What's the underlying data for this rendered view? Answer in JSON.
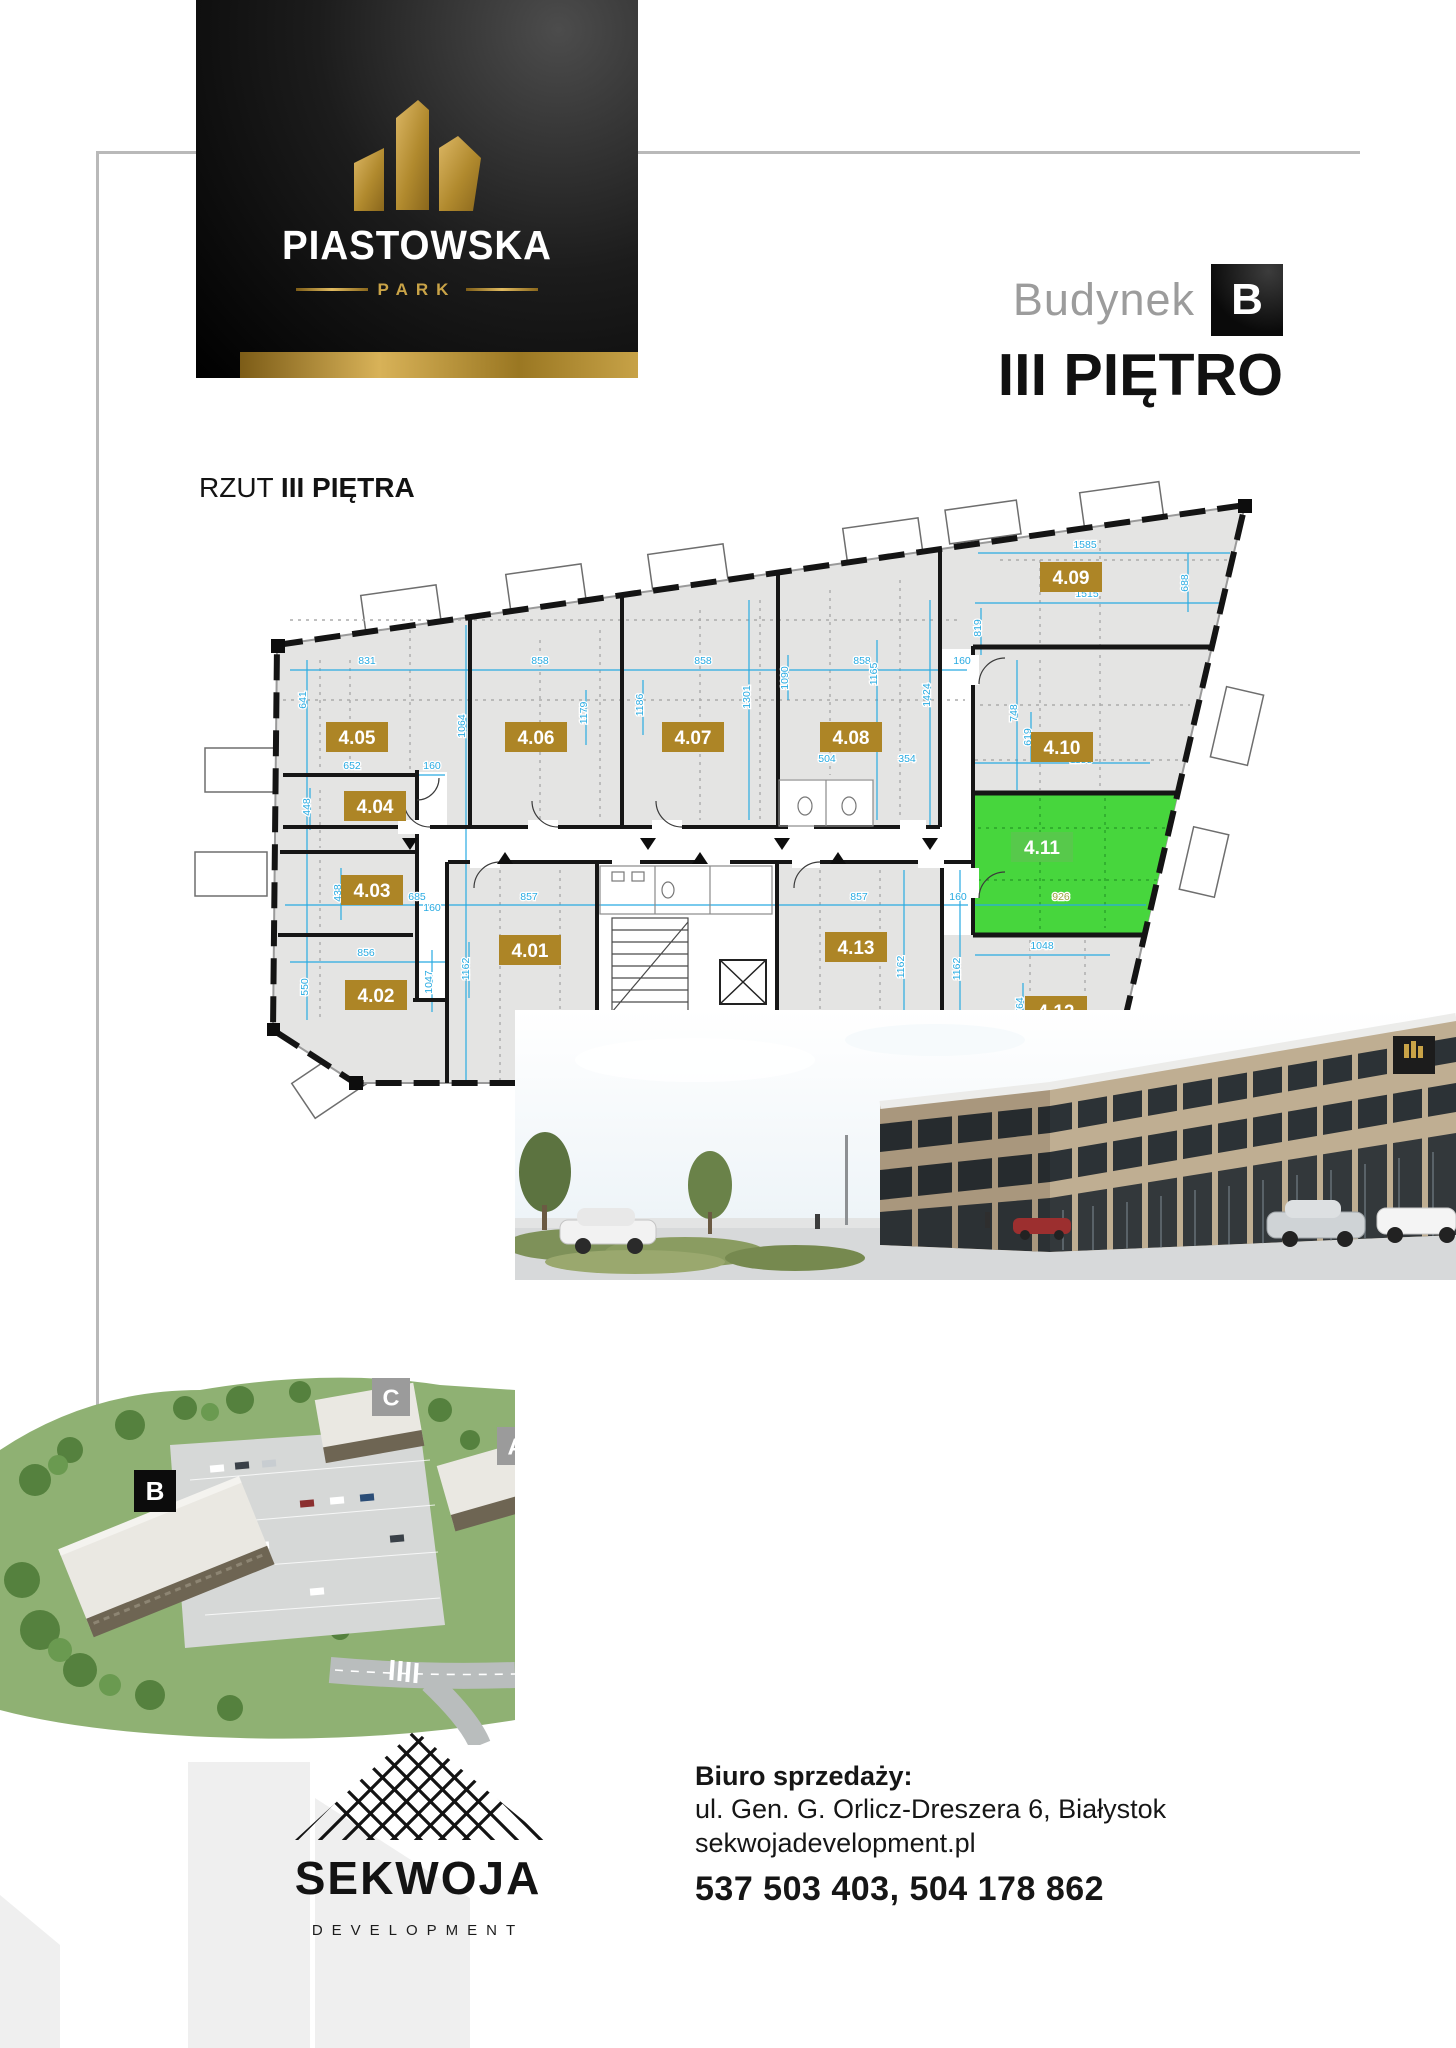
{
  "brand": {
    "name": "PIASTOWSKA",
    "sub": "PARK"
  },
  "heading": {
    "building_label": "Budynek",
    "building_letter": "B",
    "floor_title": "III PIĘTRO"
  },
  "plan": {
    "title_prefix": "RZUT ",
    "title_bold": "III PIĘTRA",
    "colors": {
      "badge_gold": "#ad8526",
      "badge_green": "#57c94b",
      "room_green": "#47d63d",
      "dim_blue": "#29abe2"
    },
    "units": [
      {
        "id": "4.01",
        "x": 530,
        "y": 950,
        "highlighted": false
      },
      {
        "id": "4.02",
        "x": 376,
        "y": 995,
        "highlighted": false
      },
      {
        "id": "4.03",
        "x": 372,
        "y": 890,
        "highlighted": false
      },
      {
        "id": "4.04",
        "x": 375,
        "y": 806,
        "highlighted": false
      },
      {
        "id": "4.05",
        "x": 357,
        "y": 737,
        "highlighted": false
      },
      {
        "id": "4.06",
        "x": 536,
        "y": 737,
        "highlighted": false
      },
      {
        "id": "4.07",
        "x": 693,
        "y": 737,
        "highlighted": false
      },
      {
        "id": "4.08",
        "x": 851,
        "y": 737,
        "highlighted": false
      },
      {
        "id": "4.09",
        "x": 1071,
        "y": 577,
        "highlighted": false
      },
      {
        "id": "4.10",
        "x": 1062,
        "y": 747,
        "highlighted": false
      },
      {
        "id": "4.11",
        "x": 1042,
        "y": 847,
        "highlighted": true
      },
      {
        "id": "4.12",
        "x": 1056,
        "y": 1011,
        "highlighted": false
      },
      {
        "id": "4.13",
        "x": 856,
        "y": 947,
        "highlighted": false
      }
    ],
    "dimensions": [
      {
        "v": "831",
        "x": 367,
        "y": 664,
        "r": 0
      },
      {
        "v": "858",
        "x": 540,
        "y": 664,
        "r": 0
      },
      {
        "v": "858",
        "x": 703,
        "y": 664,
        "r": 0
      },
      {
        "v": "858",
        "x": 862,
        "y": 664,
        "r": 0
      },
      {
        "v": "160",
        "x": 962,
        "y": 664,
        "r": 0
      },
      {
        "v": "1585",
        "x": 1085,
        "y": 548,
        "r": 0
      },
      {
        "v": "1515",
        "x": 1087,
        "y": 597,
        "r": 0
      },
      {
        "v": "688",
        "x": 1188,
        "y": 583,
        "r": -90
      },
      {
        "v": "819",
        "x": 981,
        "y": 628,
        "r": -90
      },
      {
        "v": "641",
        "x": 306,
        "y": 700,
        "r": -90
      },
      {
        "v": "1064",
        "x": 465,
        "y": 726,
        "r": -90
      },
      {
        "v": "1179",
        "x": 587,
        "y": 713,
        "r": -90
      },
      {
        "v": "1186",
        "x": 643,
        "y": 705,
        "r": -90
      },
      {
        "v": "1301",
        "x": 750,
        "y": 697,
        "r": -90
      },
      {
        "v": "1090",
        "x": 788,
        "y": 678,
        "r": -90
      },
      {
        "v": "1165",
        "x": 877,
        "y": 674,
        "r": -90
      },
      {
        "v": "1424",
        "x": 930,
        "y": 695,
        "r": -90
      },
      {
        "v": "748",
        "x": 1017,
        "y": 713,
        "r": -90
      },
      {
        "v": "619",
        "x": 1031,
        "y": 737,
        "r": -90
      },
      {
        "v": "652",
        "x": 352,
        "y": 769,
        "r": 0
      },
      {
        "v": "160",
        "x": 432,
        "y": 769,
        "r": 0
      },
      {
        "v": "448",
        "x": 310,
        "y": 807,
        "r": -90
      },
      {
        "v": "504",
        "x": 827,
        "y": 762,
        "r": 0
      },
      {
        "v": "354",
        "x": 907,
        "y": 762,
        "r": 0
      },
      {
        "v": "438",
        "x": 341,
        "y": 893,
        "r": -90
      },
      {
        "v": "685",
        "x": 417,
        "y": 900,
        "r": 0
      },
      {
        "v": "160",
        "x": 432,
        "y": 911,
        "r": 0
      },
      {
        "v": "857",
        "x": 529,
        "y": 900,
        "r": 0
      },
      {
        "v": "857",
        "x": 859,
        "y": 900,
        "r": 0
      },
      {
        "v": "160",
        "x": 958,
        "y": 900,
        "r": 0
      },
      {
        "v": "856",
        "x": 366,
        "y": 956,
        "r": 0
      },
      {
        "v": "550",
        "x": 308,
        "y": 987,
        "r": -90
      },
      {
        "v": "1047",
        "x": 432,
        "y": 982,
        "r": -90
      },
      {
        "v": "1162",
        "x": 469,
        "y": 969,
        "r": -90
      },
      {
        "v": "1162",
        "x": 904,
        "y": 967,
        "r": -90
      },
      {
        "v": "1162",
        "x": 960,
        "y": 969,
        "r": -90
      },
      {
        "v": "926",
        "x": 1061,
        "y": 900,
        "r": 0,
        "c": "#9aa23a"
      },
      {
        "v": "1048",
        "x": 1042,
        "y": 949,
        "r": 0
      },
      {
        "v": "764",
        "x": 1023,
        "y": 1006,
        "r": -90
      },
      {
        "v": "1155",
        "x": 1081,
        "y": 763,
        "r": 0
      }
    ]
  },
  "aerial": {
    "labels": [
      {
        "t": "B",
        "x": 134,
        "y": 140,
        "size": 42,
        "style": "dark"
      },
      {
        "t": "C",
        "x": 372,
        "y": 48,
        "size": 38,
        "style": "gray"
      },
      {
        "t": "A",
        "x": 497,
        "y": 97,
        "size": 38,
        "style": "gray"
      }
    ]
  },
  "footer": {
    "brand": "SEKWOJA",
    "brand_sub": "DEVELOPMENT",
    "office_label": "Biuro sprzedaży:",
    "address": "ul. Gen. G. Orlicz-Dreszera 6, Białystok",
    "website": "sekwojadevelopment.pl",
    "phones": "537 503 403, 504 178 862"
  }
}
